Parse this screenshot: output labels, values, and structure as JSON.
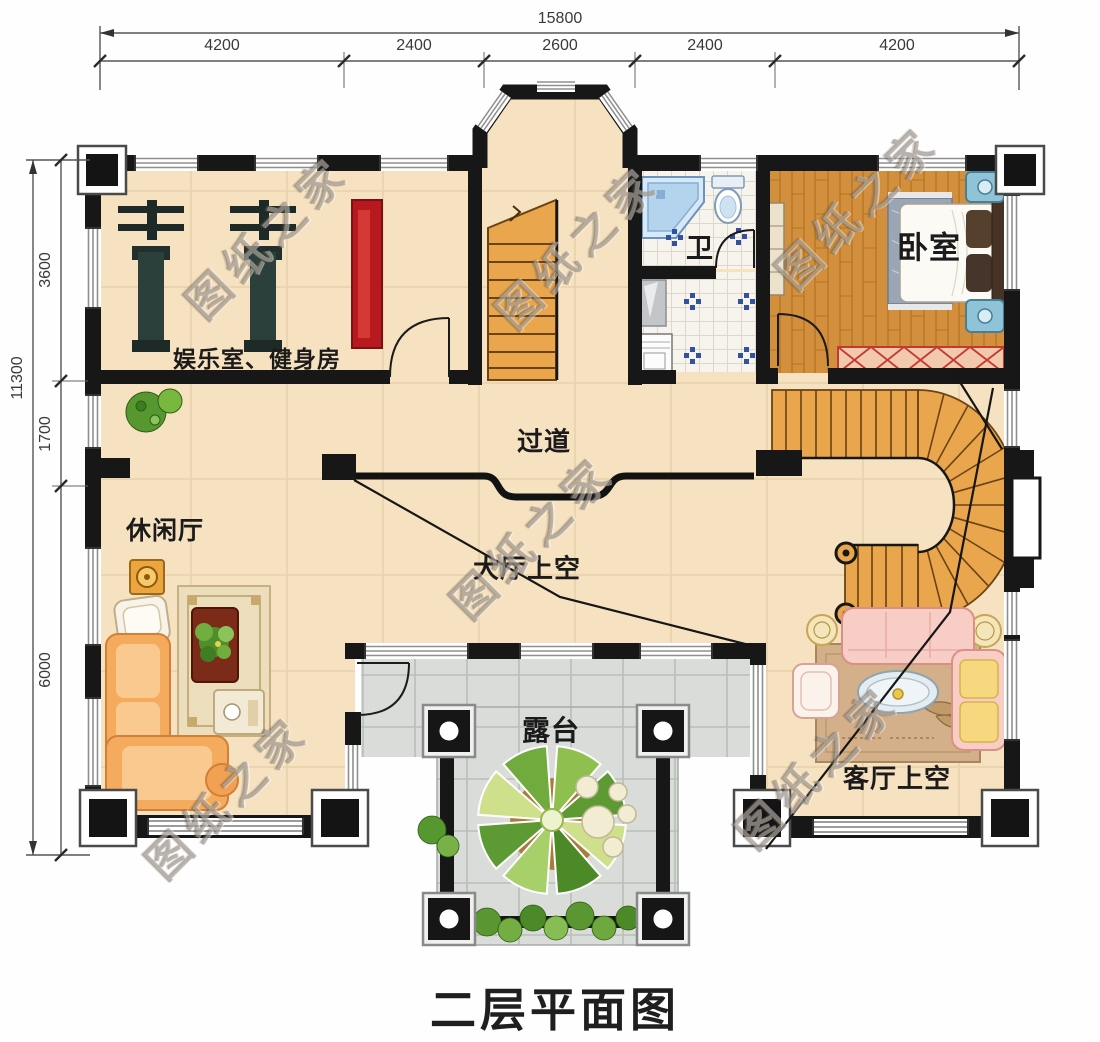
{
  "title": "二层平面图",
  "watermark": "图纸之家",
  "dims": {
    "top_total": "15800",
    "top_segments": [
      "4200",
      "2400",
      "2600",
      "2400",
      "4200"
    ],
    "left_total": "11300",
    "left_segments": [
      "3600",
      "1700",
      "6000"
    ]
  },
  "rooms": {
    "entertainment": "娱乐室、健身房",
    "bath": "卫",
    "bedroom": "卧室",
    "corridor": "过道",
    "hall_void": "大厅上空",
    "leisure": "休闲厅",
    "terrace": "露台",
    "living_void": "客厅上空"
  },
  "colors": {
    "wall": "#171717",
    "floor": "#f6e2c0",
    "wood_floor": "#d2903e",
    "stair": "#e9a64d",
    "terrace_tile": "#d9dcd8",
    "gym_mat_red": "#b8191f"
  }
}
